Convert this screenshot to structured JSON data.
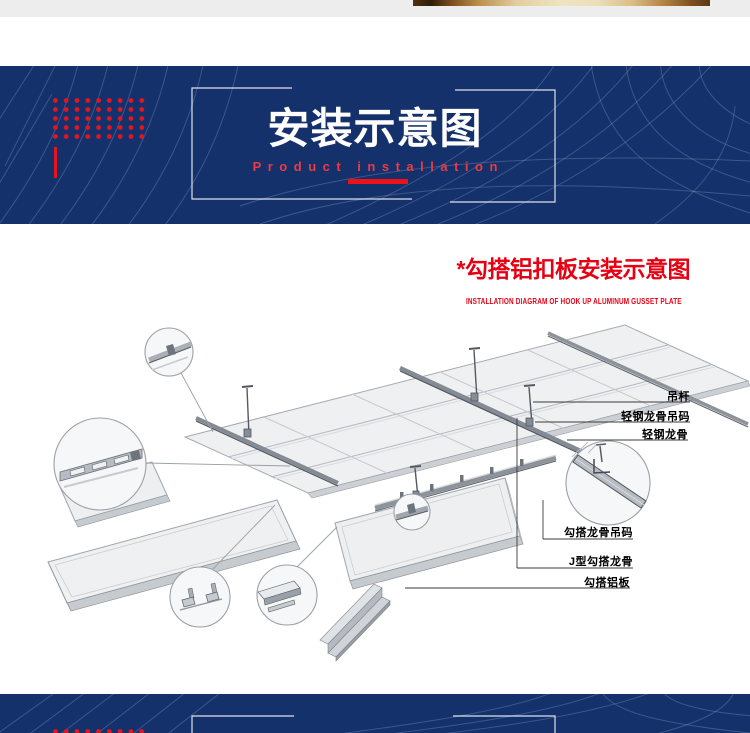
{
  "banner": {
    "title": "安装示意图",
    "subtitle": "Product installation"
  },
  "section": {
    "title": "*勾搭铝扣板安装示意图",
    "subtitle": "INSTALLATION DIAGRAM OF HOOK UP ALUMINUM GUSSET PLATE"
  },
  "diagram": {
    "labels": [
      {
        "text": "吊杆"
      },
      {
        "text": "轻钢龙骨吊码"
      },
      {
        "text": "轻钢龙骨"
      },
      {
        "text": "勾搭龙骨吊码"
      },
      {
        "text": "J型勾搭龙骨"
      },
      {
        "text": "勾搭铝板"
      }
    ]
  },
  "colors": {
    "banner_navy": "#15316b",
    "accent_red": "#e60012",
    "dot_red": "#e8131d",
    "subtitle_red": "#ee3a43"
  }
}
